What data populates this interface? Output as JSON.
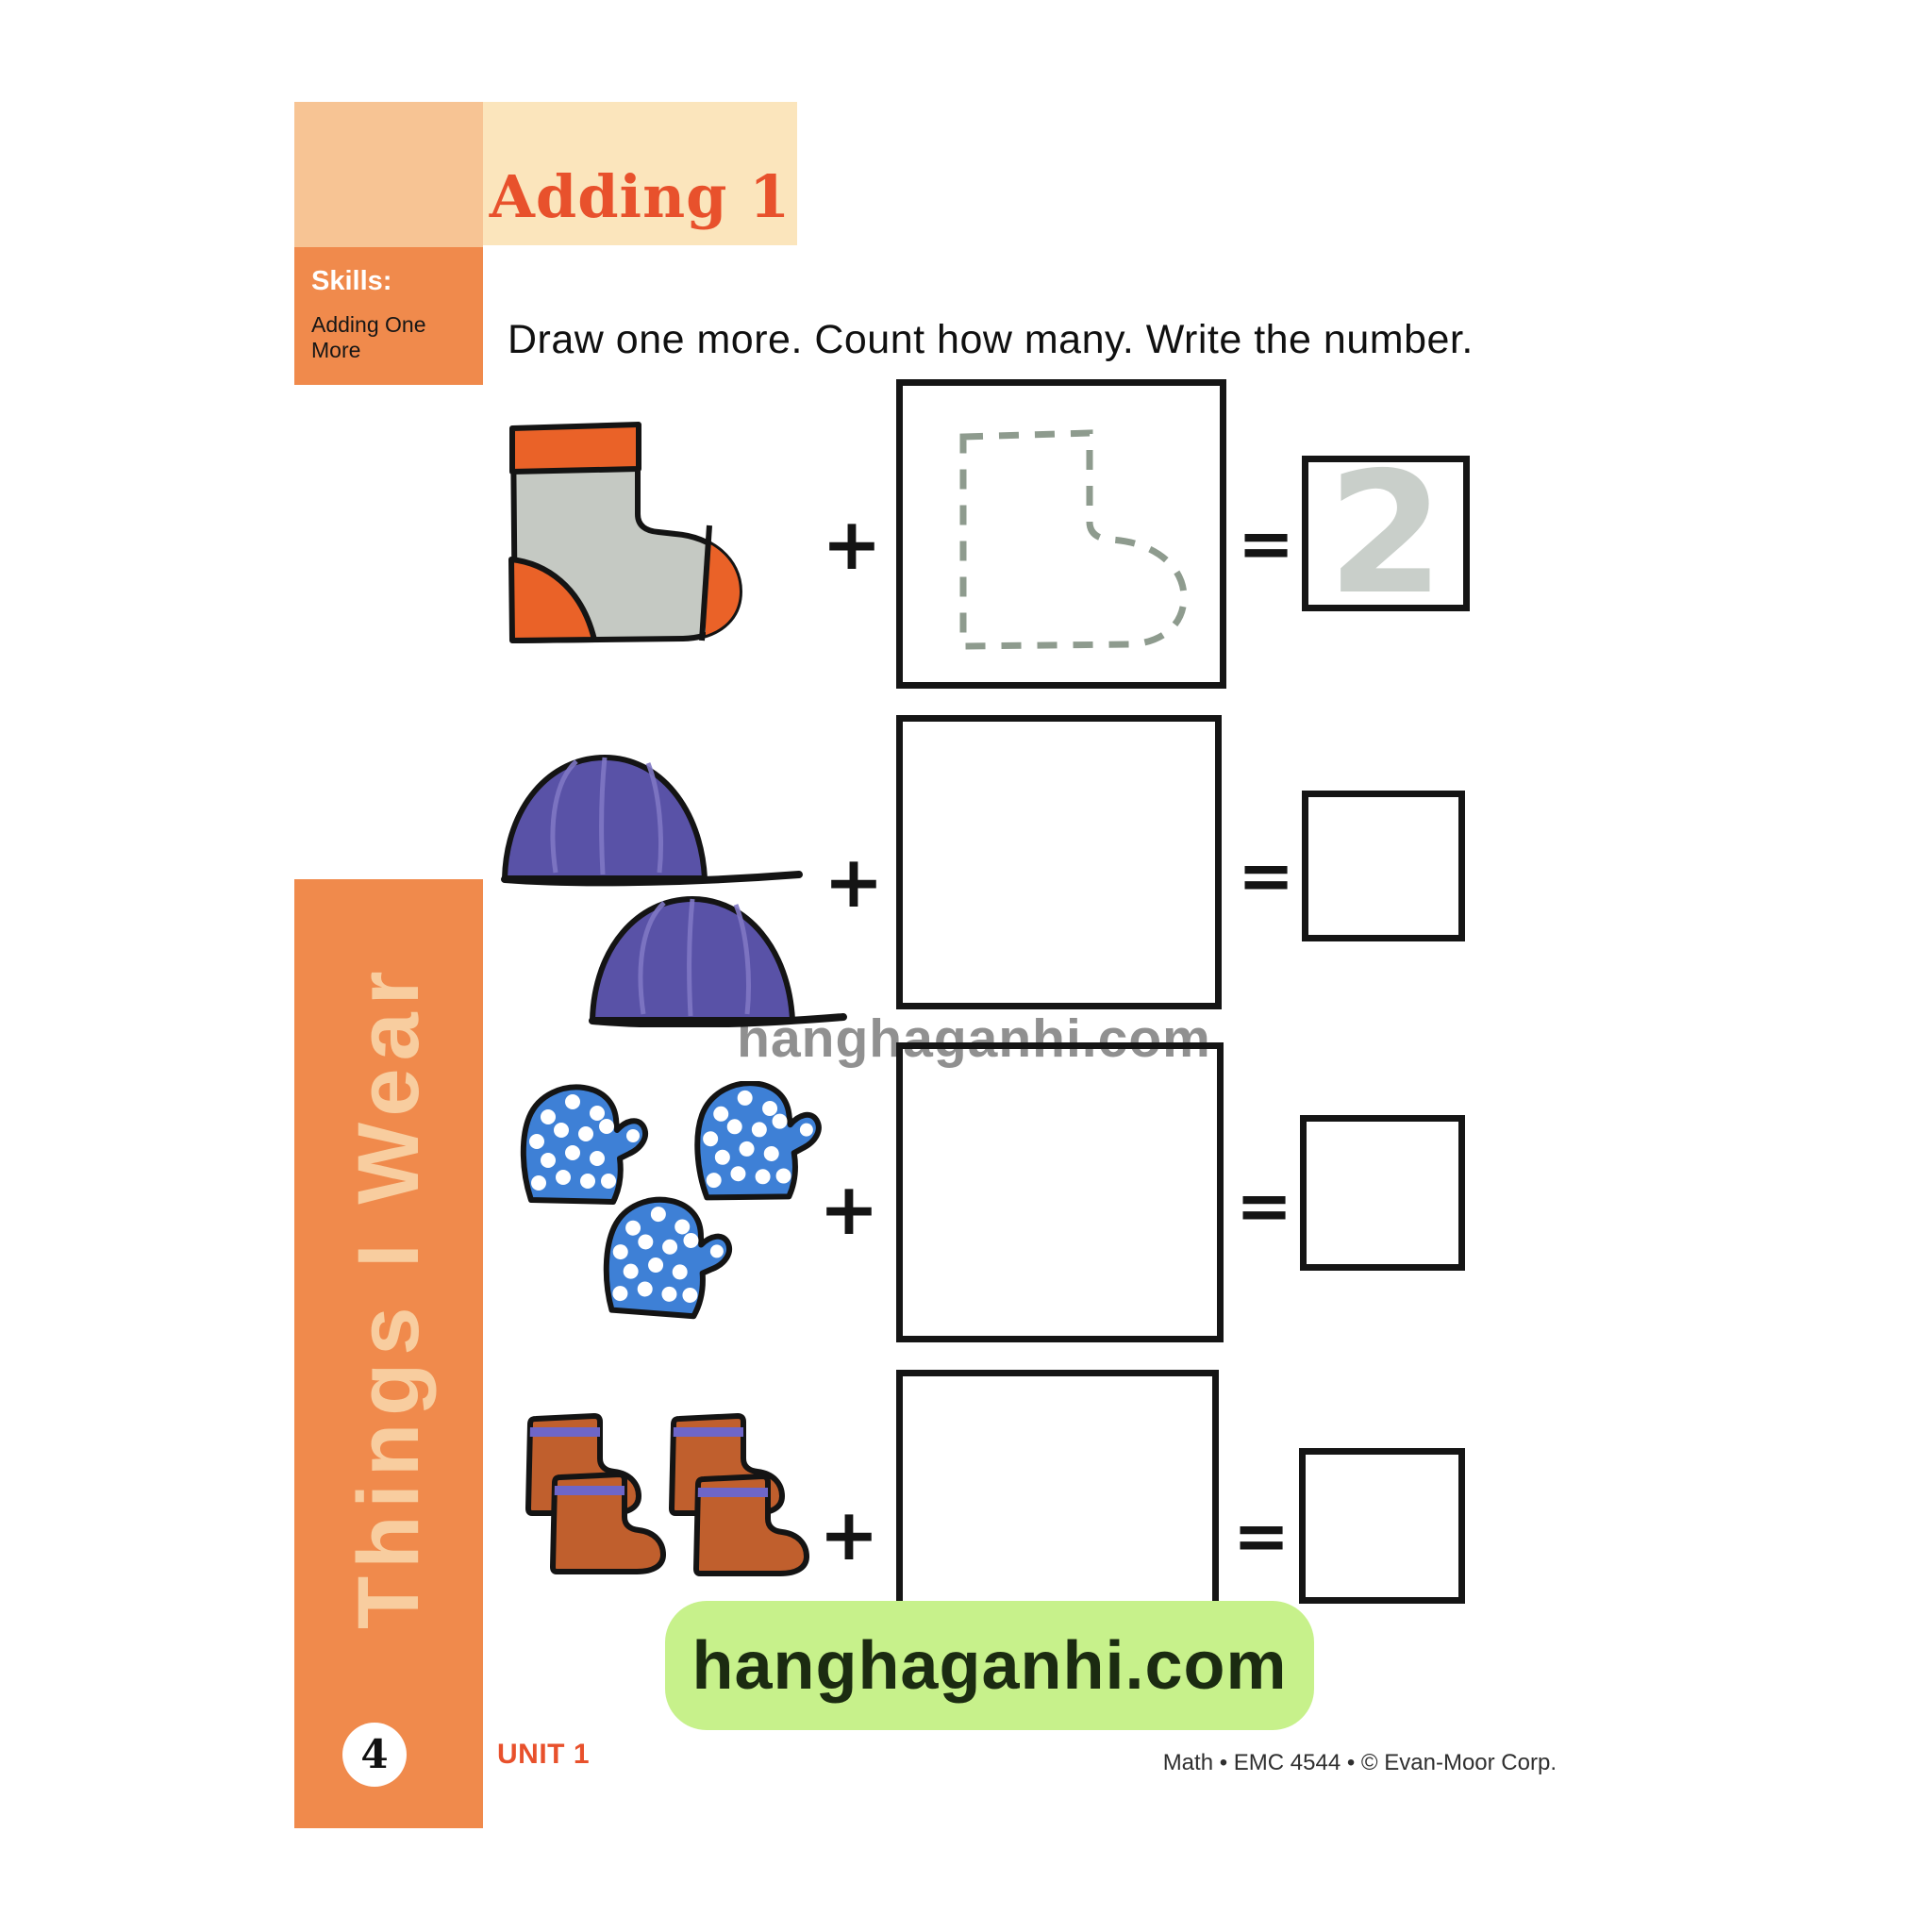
{
  "header": {
    "title": "Adding 1",
    "skills_label": "Skills:",
    "skills_text": "Adding One More",
    "colors": {
      "light_block": "#F7C494",
      "banner_bg": "#FBE5BC",
      "orange_block": "#F08A4C",
      "title_color": "#E8512C"
    }
  },
  "instruction": "Draw one more. Count how many. Write the number.",
  "worksheet": {
    "operator_plus": "+",
    "operator_equals": "=",
    "rows": [
      {
        "item": "sock",
        "item_color": "#C5C9C3",
        "accent_color": "#EA6228",
        "count": 1,
        "draw_hint": "dashed sock outline",
        "answer": "2"
      },
      {
        "item": "caps",
        "item_color": "#5952A7",
        "accent_color": "#7F77C4",
        "count": 2,
        "draw_hint": "",
        "answer": ""
      },
      {
        "item": "mittens",
        "item_color": "#3E80D6",
        "accent_color": "#FFFFFF",
        "count": 3,
        "draw_hint": "",
        "answer": ""
      },
      {
        "item": "boots",
        "item_color": "#C05F2D",
        "accent_color": "#6E66C8",
        "count": 4,
        "draw_hint": "",
        "answer": ""
      }
    ],
    "trace_color": "#C9CFCA",
    "dash_color": "#8E9B8E"
  },
  "sidebar": {
    "label": "Things I Wear",
    "page_number": "4",
    "bg": "#F08A4C",
    "text_color": "#F8CD9F"
  },
  "footer": {
    "unit": "UNIT 1",
    "credit": "Math • EMC 4544 • © Evan-Moor Corp."
  },
  "watermark": {
    "center_text": "hanghaganhi.com",
    "badge_text": "hanghaganhi.com",
    "badge_bg": "#C7F18B"
  }
}
